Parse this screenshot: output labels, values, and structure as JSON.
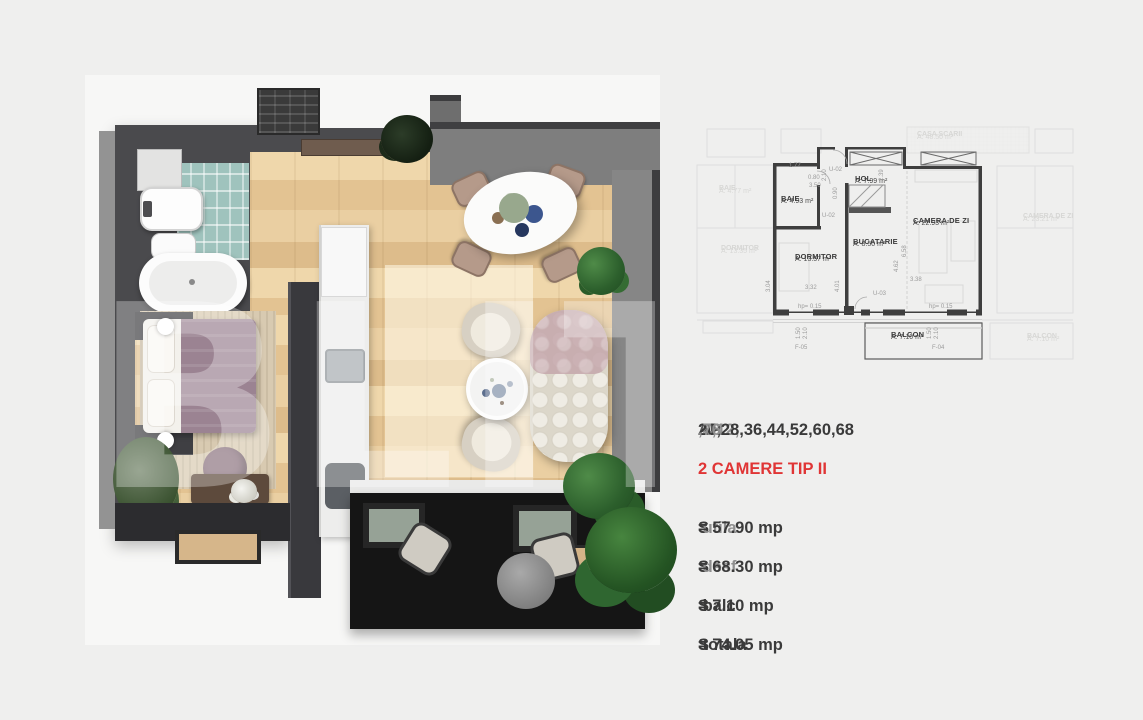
{
  "colors": {
    "accent_red": "#e03535",
    "text_dark": "#3a3a3a",
    "text_gray": "#8f8f8f",
    "wall_dark": "#4a4a4d",
    "wood_floor": "#e7c99b",
    "tile_teal": "#9fc3bd",
    "balcony_dark": "#151515",
    "plant_green": "#2c5f2c",
    "page_bg": "#efefee"
  },
  "watermark": "BLITZ",
  "plan2d": {
    "rooms": [
      {
        "name": "BAIE",
        "area": "A: 4.93 m²"
      },
      {
        "name": "HOL",
        "area": "A: 7.99 m²"
      },
      {
        "name": "DORMITOR",
        "area": "A: 13.57 m²"
      },
      {
        "name": "BUCATARIE",
        "area": "A: 8.50 m²"
      },
      {
        "name": "CAMERA DE ZI",
        "area": "A: 22.93 m²"
      },
      {
        "name": "BALCON",
        "area": "A: 7.10 m²"
      }
    ],
    "faint": [
      {
        "name": "CASA SCARII",
        "area": "A: 48.50 m²"
      },
      {
        "name": "BAIE",
        "area": "A: 4.77 m²"
      },
      {
        "name": "DORMITOR",
        "area": "A: 13.35 m²"
      },
      {
        "name": "CAMERA DE ZI",
        "area": "A: 23.21 m²"
      },
      {
        "name": "BALCON",
        "area": "A: 7.10 m²"
      }
    ],
    "dims": [
      "1.77",
      "0.80",
      "3.50",
      "2.10",
      "U-02",
      "U-02",
      "0.90",
      "2.39",
      "3.04",
      "3.32",
      "4.01",
      "6.58",
      "4.62",
      "3.38",
      "U-03",
      "hp= 0.15",
      "hp= 0.15",
      "1.50",
      "2.10",
      "F-05",
      "F-04",
      "1.50",
      "2.10"
    ]
  },
  "info": {
    "ap_prefix": "AP.",
    "ap_gray1": " 4,12,",
    "ap_bold": "20,28,36,44,52,60,68",
    "ap_gray2": ",76",
    "type_line": "2 CAMERE TIP II",
    "lines": [
      {
        "s": "S",
        "label": " utila ",
        "value": "= 57.90 mp"
      },
      {
        "s": "S",
        "label": " desf ",
        "value": "= 68.30 mp"
      },
      {
        "s": "S",
        "label": " balc ",
        "value": "= 7.10 mp"
      },
      {
        "s": "S",
        "label": " totala ",
        "value": "= 74.05 mp"
      }
    ]
  }
}
